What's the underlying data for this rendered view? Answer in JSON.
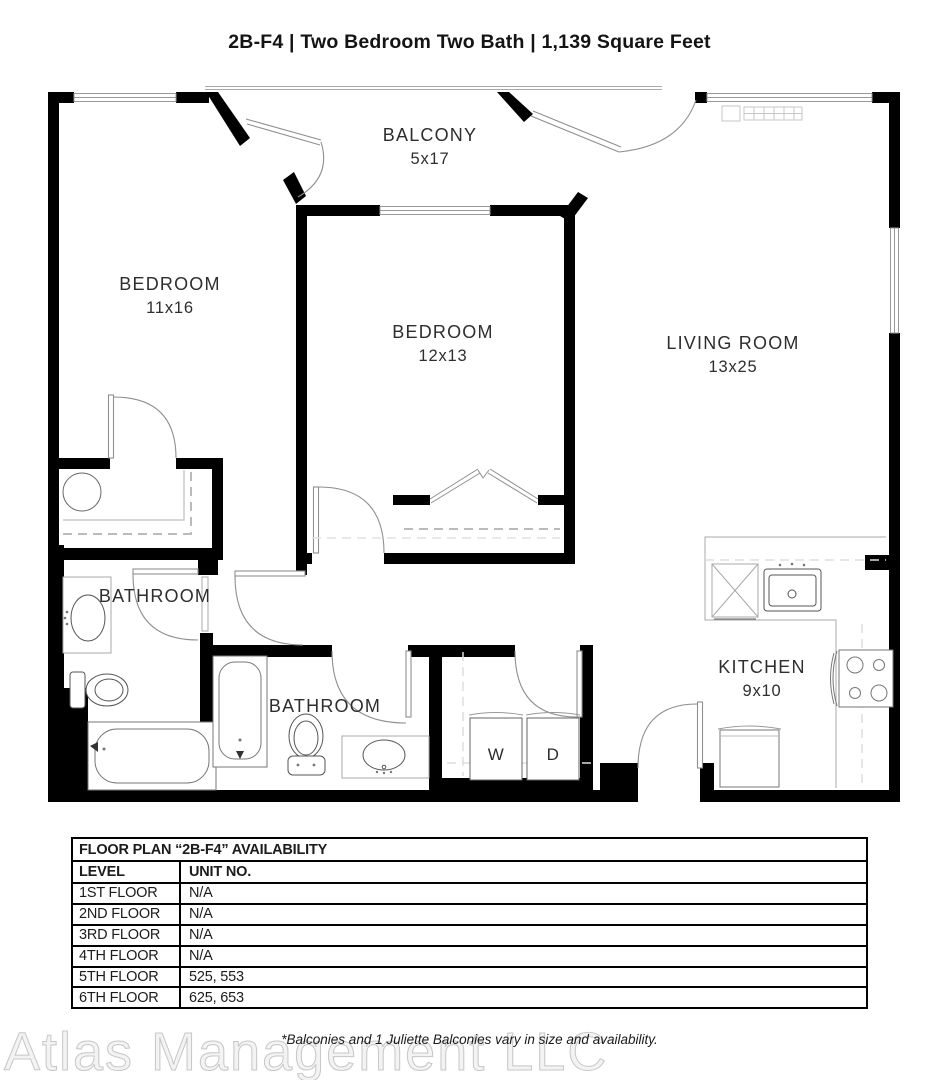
{
  "header": {
    "title": "2B-F4 | Two Bedroom Two Bath | 1,139 Square Feet"
  },
  "floor_plan": {
    "rooms": {
      "balcony": {
        "name": "BALCONY",
        "dims": "5x17"
      },
      "bedroom1": {
        "name": "BEDROOM",
        "dims": "11x16"
      },
      "bedroom2": {
        "name": "BEDROOM",
        "dims": "12x13"
      },
      "living_room": {
        "name": "LIVING ROOM",
        "dims": "13x25"
      },
      "bathroom1": {
        "name": "BATHROOM"
      },
      "bathroom2": {
        "name": "BATHROOM"
      },
      "kitchen": {
        "name": "KITCHEN",
        "dims": "9x10"
      }
    },
    "appliances": {
      "washer": "W",
      "dryer": "D"
    },
    "colors": {
      "wall": "#000000",
      "fixture": "#6e6e6e",
      "counter": "#a9a9a9"
    }
  },
  "availability_table": {
    "title": "FLOOR PLAN “2B-F4” AVAILABILITY",
    "columns": {
      "level": "LEVEL",
      "unit": "UNIT NO."
    },
    "rows": [
      {
        "level": "1ST FLOOR",
        "units": "N/A"
      },
      {
        "level": "2ND FLOOR",
        "units": "N/A"
      },
      {
        "level": "3RD FLOOR",
        "units": "N/A"
      },
      {
        "level": "4TH FLOOR",
        "units": "N/A"
      },
      {
        "level": "5TH FLOOR",
        "units": "525, 553"
      },
      {
        "level": "6TH FLOOR",
        "units": "625, 653"
      }
    ]
  },
  "footer": {
    "note": "*Balconies and 1 Juliette Balconies vary in size and availability.",
    "watermark": "Atlas Management LLC"
  }
}
